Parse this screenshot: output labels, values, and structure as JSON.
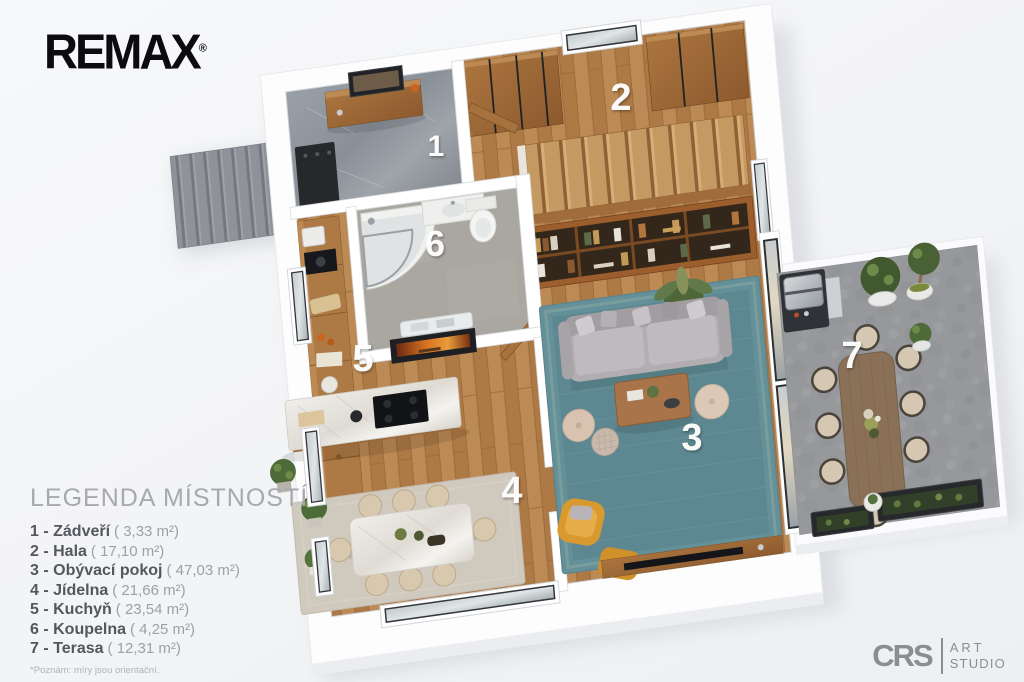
{
  "brand": {
    "name": "REMAX",
    "registered": "®"
  },
  "legend": {
    "title": "LEGENDA MÍSTNOSTÍ",
    "items": [
      {
        "num": "1",
        "label": "1 - Zádveří",
        "area": "( 3,33 m²)"
      },
      {
        "num": "2",
        "label": "2 - Hala",
        "area": "( 17,10 m²)"
      },
      {
        "num": "3",
        "label": "3 - Obývací pokoj",
        "area": "( 47,03 m²)"
      },
      {
        "num": "4",
        "label": "4 - Jídelna",
        "area": "( 21,66 m²)"
      },
      {
        "num": "5",
        "label": "5 - Kuchyň",
        "area": "( 23,54 m²)"
      },
      {
        "num": "6",
        "label": "6 - Koupelna",
        "area": "( 4,25 m²)"
      },
      {
        "num": "7",
        "label": "7 - Terasa",
        "area": "( 12,31 m²)"
      }
    ],
    "footnote": "*Poznám: míry jsou orientační."
  },
  "watermark": {
    "initials": "CRS",
    "line1": "ART",
    "line2": "STUDIO"
  },
  "colors": {
    "wood_floor": "#b5824e",
    "rug_teal": "#649099",
    "dining_rug": "#cfc9be",
    "accent_yellow": "#d8992e",
    "sofa_gray": "#b2adb0",
    "terrace_stone": "#97989b",
    "entry_marble": "#8f959c",
    "bath_floor": "#a9a7a0",
    "legend_bold_text": "#54575e",
    "legend_light_text": "#9da0a6"
  }
}
